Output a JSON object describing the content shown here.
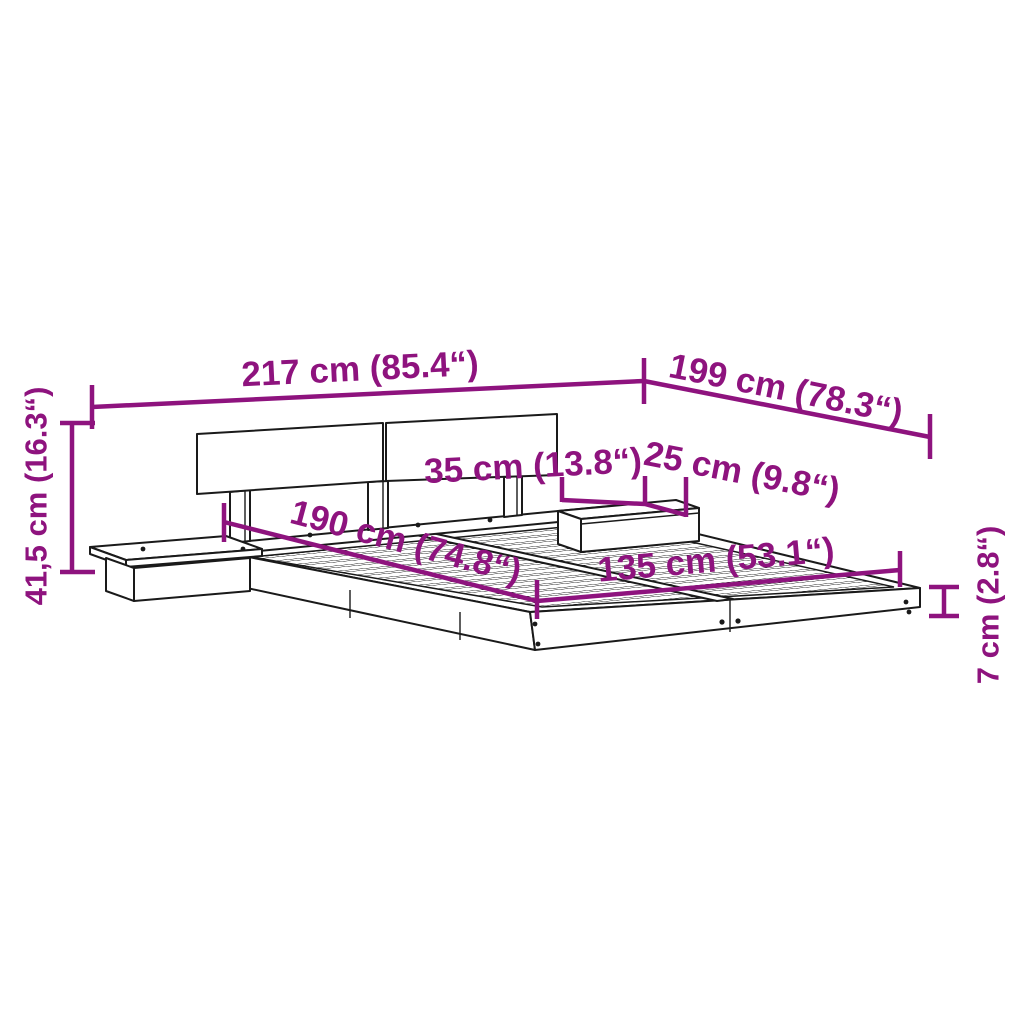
{
  "diagram": {
    "kind": "product dimension diagram",
    "product": "floating bed frame with split headboard and two side shelves",
    "colors": {
      "accent": "#8e137e",
      "line_art": "#1a1a1a",
      "background": "#ffffff"
    },
    "dims": {
      "overall_width": {
        "value": "217 cm (85.4“)"
      },
      "overall_length": {
        "value": "199 cm (78.3“)"
      },
      "overall_height": {
        "value": "41,5 cm (16.3“)"
      },
      "shelf_width": {
        "value": "35 cm (13.8“)"
      },
      "shelf_depth": {
        "value": "25 cm (9.8“)"
      },
      "slat_area_length": {
        "value": "190 cm (74.8“)"
      },
      "slat_area_width": {
        "value": "135 cm (53.1“)"
      },
      "frame_thickness": {
        "value": "7 cm (2.8“)"
      }
    }
  }
}
